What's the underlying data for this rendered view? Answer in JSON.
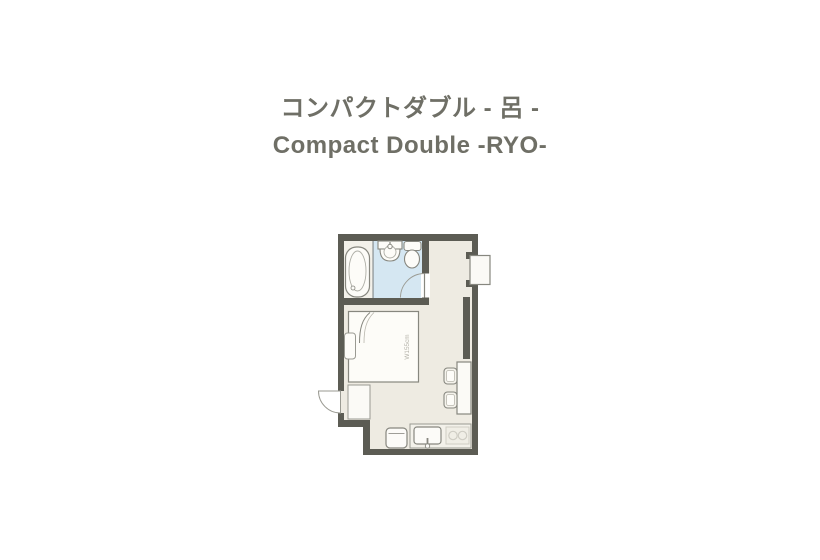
{
  "title": {
    "ja": "コンパクトダブル - 呂 -",
    "en": "Compact Double -RYO-"
  },
  "floorplan": {
    "bed_label": "W155cm",
    "fixtures": [
      "bathtub",
      "washbasin",
      "toilet",
      "bathroom-door",
      "double-bed",
      "pillow",
      "entrance-door",
      "entry-step",
      "ac-unit",
      "tv-counter",
      "desk",
      "stool",
      "stool",
      "mini-fridge",
      "kitchen-sink",
      "two-burner-stove"
    ],
    "colors": {
      "wall": "#5c5c54",
      "floor": "#eeebe2",
      "bathroom_floor": "#d5e7f2",
      "fixture_stroke": "#87877f",
      "title_text": "#6f6f66"
    }
  }
}
